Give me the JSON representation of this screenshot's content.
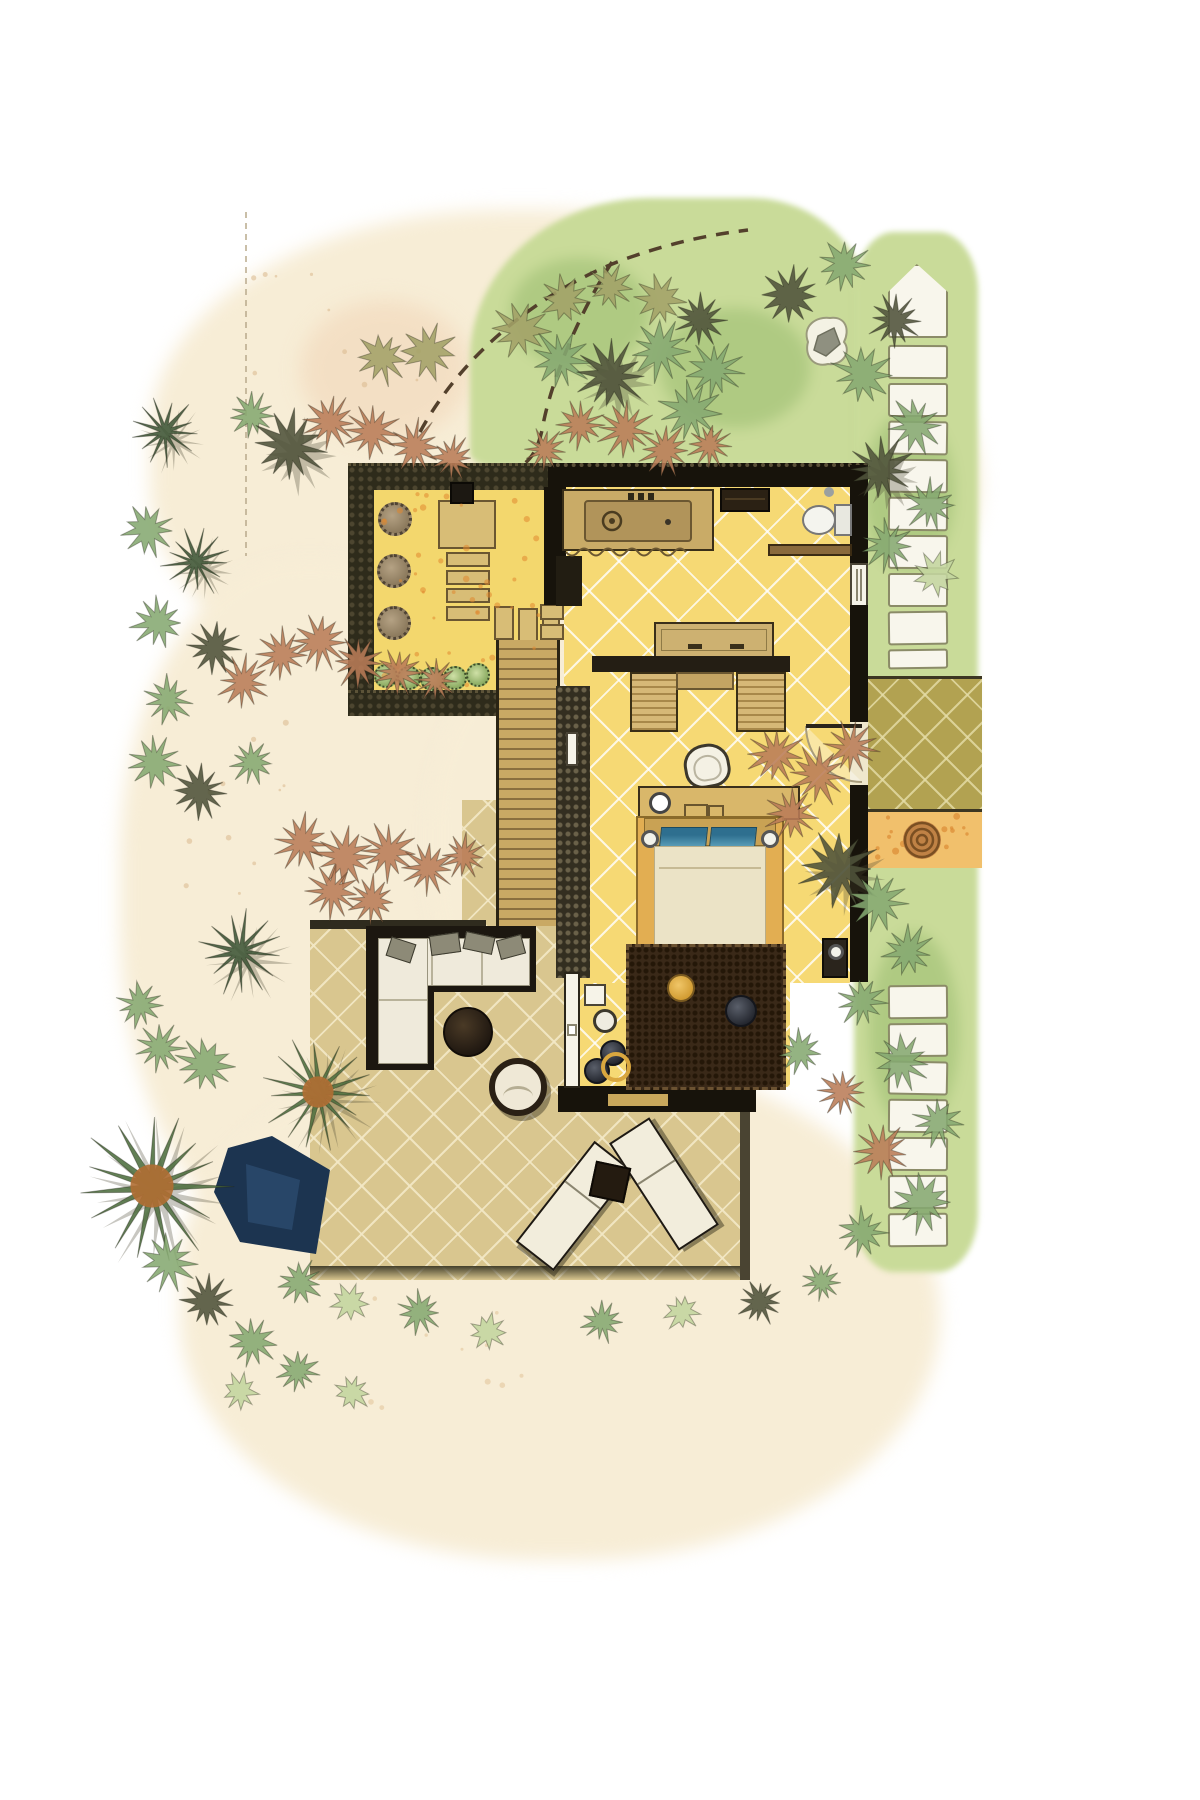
{
  "scene": {
    "kind": "hand-rendered resort villa floor plan, top view, watercolor style",
    "areas": [
      "garden-courtyard",
      "bathroom",
      "bedroom",
      "timber-boardwalk",
      "terrace-deck",
      "entry-porch",
      "plunge-pool",
      "lawn-with-stepping-stones",
      "sand-paths"
    ],
    "palette": {
      "floor_yellow": "#f6d974",
      "deck_tan": "#d9c68f",
      "porch_khaki": "#b2a251",
      "gravel_yellow": "#f3d76d",
      "wall_dark": "#17130b",
      "pool_navy": "#1c3450",
      "lawn_green": "#c9db99",
      "sand_cream": "#f7edd6",
      "pillow_blue": "#2e6f8f",
      "rug_brown": "#3a2918",
      "wood": "#c9a964",
      "shrub_red": "#b97c58"
    }
  },
  "plant_types": {
    "olive": {
      "color": "#a3a268",
      "spikes": 10,
      "inner": 0.45
    },
    "green": {
      "color": "#85a871",
      "spikes": 11,
      "inner": 0.42
    },
    "dark": {
      "color": "#4f523a",
      "spikes": 12,
      "inner": 0.4
    },
    "red": {
      "color": "#b97c58",
      "spikes": 12,
      "inner": 0.38
    },
    "lightgreen": {
      "color": "#c3d59e",
      "spikes": 9,
      "inner": 0.5
    },
    "palm": {
      "color": "#3d5537",
      "spikes": 13,
      "inner": 0.22
    },
    "palm2": {
      "color": "#4c6d3d",
      "spikes": 15,
      "inner": 0.2,
      "center": "#b06e33"
    }
  },
  "plants": [
    [
      382,
      358,
      26,
      "olive"
    ],
    [
      428,
      352,
      28,
      "olive"
    ],
    [
      252,
      415,
      22,
      "green"
    ],
    [
      290,
      447,
      36,
      "dark"
    ],
    [
      330,
      422,
      26,
      "red"
    ],
    [
      372,
      432,
      27,
      "red"
    ],
    [
      415,
      446,
      26,
      "red"
    ],
    [
      452,
      458,
      22,
      "red"
    ],
    [
      520,
      330,
      28,
      "olive"
    ],
    [
      565,
      300,
      24,
      "olive"
    ],
    [
      610,
      287,
      22,
      "olive"
    ],
    [
      660,
      300,
      24,
      "olive"
    ],
    [
      560,
      360,
      30,
      "green"
    ],
    [
      610,
      375,
      36,
      "dark"
    ],
    [
      660,
      350,
      30,
      "green"
    ],
    [
      700,
      320,
      26,
      "dark"
    ],
    [
      715,
      370,
      28,
      "green"
    ],
    [
      690,
      412,
      30,
      "green"
    ],
    [
      625,
      430,
      28,
      "red"
    ],
    [
      580,
      425,
      24,
      "red"
    ],
    [
      545,
      450,
      22,
      "red"
    ],
    [
      665,
      450,
      26,
      "red"
    ],
    [
      710,
      445,
      22,
      "red"
    ],
    [
      790,
      295,
      30,
      "dark"
    ],
    [
      845,
      265,
      26,
      "green"
    ],
    [
      895,
      320,
      26,
      "dark"
    ],
    [
      862,
      375,
      30,
      "green"
    ],
    [
      915,
      425,
      28,
      "green"
    ],
    [
      880,
      470,
      32,
      "dark"
    ],
    [
      930,
      505,
      26,
      "green"
    ],
    [
      888,
      545,
      26,
      "green"
    ],
    [
      935,
      575,
      22,
      "lightgreen"
    ],
    [
      165,
      432,
      32,
      "palm"
    ],
    [
      148,
      530,
      26,
      "green"
    ],
    [
      196,
      562,
      32,
      "palm"
    ],
    [
      158,
      622,
      26,
      "green"
    ],
    [
      214,
      648,
      26,
      "dark"
    ],
    [
      168,
      700,
      24,
      "green"
    ],
    [
      243,
      682,
      26,
      "red"
    ],
    [
      282,
      655,
      26,
      "red"
    ],
    [
      320,
      642,
      28,
      "red"
    ],
    [
      358,
      662,
      26,
      "red"
    ],
    [
      398,
      672,
      24,
      "red"
    ],
    [
      436,
      680,
      22,
      "red"
    ],
    [
      155,
      762,
      26,
      "green"
    ],
    [
      200,
      792,
      28,
      "dark"
    ],
    [
      252,
      762,
      22,
      "green"
    ],
    [
      302,
      842,
      28,
      "red"
    ],
    [
      345,
      856,
      30,
      "red"
    ],
    [
      388,
      852,
      28,
      "red"
    ],
    [
      428,
      868,
      26,
      "red"
    ],
    [
      464,
      856,
      22,
      "red"
    ],
    [
      332,
      892,
      26,
      "red"
    ],
    [
      372,
      900,
      24,
      "red"
    ],
    [
      240,
      952,
      40,
      "palm"
    ],
    [
      205,
      1065,
      28,
      "green"
    ],
    [
      160,
      1048,
      24,
      "green"
    ],
    [
      140,
      1005,
      22,
      "green"
    ],
    [
      318,
      1092,
      52,
      "palm2"
    ],
    [
      152,
      1186,
      72,
      "palm2"
    ],
    [
      300,
      1282,
      22,
      "green"
    ],
    [
      350,
      1302,
      18,
      "lightgreen"
    ],
    [
      168,
      1262,
      28,
      "green"
    ],
    [
      208,
      1302,
      26,
      "dark"
    ],
    [
      252,
      1342,
      24,
      "green"
    ],
    [
      298,
      1372,
      20,
      "green"
    ],
    [
      352,
      1392,
      18,
      "lightgreen"
    ],
    [
      240,
      1392,
      18,
      "lightgreen"
    ],
    [
      775,
      755,
      28,
      "red"
    ],
    [
      818,
      775,
      30,
      "red"
    ],
    [
      852,
      748,
      26,
      "red"
    ],
    [
      792,
      815,
      26,
      "red"
    ],
    [
      838,
      868,
      38,
      "dark"
    ],
    [
      878,
      902,
      30,
      "green"
    ],
    [
      908,
      952,
      26,
      "green"
    ],
    [
      862,
      1002,
      24,
      "green"
    ],
    [
      902,
      1062,
      28,
      "green"
    ],
    [
      938,
      1122,
      24,
      "green"
    ],
    [
      882,
      1152,
      28,
      "red"
    ],
    [
      922,
      1202,
      30,
      "green"
    ],
    [
      862,
      1232,
      24,
      "green"
    ],
    [
      800,
      1052,
      22,
      "green"
    ],
    [
      842,
      1092,
      24,
      "red"
    ],
    [
      420,
      1312,
      22,
      "green"
    ],
    [
      488,
      1332,
      18,
      "lightgreen"
    ],
    [
      602,
      1322,
      20,
      "green"
    ],
    [
      682,
      1312,
      18,
      "lightgreen"
    ],
    [
      760,
      1302,
      22,
      "dark"
    ],
    [
      822,
      1282,
      18,
      "green"
    ]
  ],
  "stepping_stones": {
    "x": 888,
    "w": 60,
    "h": 34,
    "upper_ys": [
      345,
      383,
      421,
      459,
      497,
      535,
      573,
      611
    ],
    "upper_truncated": {
      "y": 649,
      "h": 20
    },
    "lower_ys": [
      985,
      1023,
      1061,
      1099,
      1137,
      1175,
      1213
    ]
  },
  "courtyard": {
    "shrubs": [
      {
        "cx": 395,
        "cy": 519,
        "r": 17
      },
      {
        "cx": 394,
        "cy": 571,
        "r": 17
      },
      {
        "cx": 394,
        "cy": 623,
        "r": 17
      }
    ],
    "steps_col": [
      [
        446,
        552,
        44,
        15
      ],
      [
        446,
        570,
        44,
        15
      ],
      [
        446,
        588,
        44,
        15
      ],
      [
        446,
        606,
        44,
        15
      ]
    ],
    "steps_row": [
      [
        494,
        606,
        20,
        34
      ],
      [
        518,
        608,
        20,
        34
      ],
      [
        542,
        610,
        18,
        34
      ]
    ],
    "steps_down": [
      [
        498,
        648,
        60,
        15
      ],
      [
        498,
        666,
        60,
        15
      ],
      [
        498,
        684,
        60,
        15
      ],
      [
        498,
        702,
        60,
        15
      ],
      [
        498,
        720,
        60,
        15
      ]
    ],
    "west_slabs": [
      [
        540,
        604,
        24,
        16
      ],
      [
        540,
        624,
        24,
        16
      ]
    ],
    "bushes": [
      {
        "cx": 386,
        "cy": 676,
        "r": 12
      },
      {
        "cx": 409,
        "cy": 678,
        "r": 12
      },
      {
        "cx": 432,
        "cy": 679,
        "r": 12
      },
      {
        "cx": 455,
        "cy": 678,
        "r": 12
      },
      {
        "cx": 478,
        "cy": 675,
        "r": 12
      }
    ]
  },
  "bed": {
    "pillows": [
      {
        "x": 660,
        "y": 827,
        "w": 47,
        "h": 22
      },
      {
        "x": 710,
        "y": 827,
        "w": 46,
        "h": 22
      }
    ],
    "bolsters": [
      {
        "x": 656,
        "y": 946,
        "w": 20,
        "h": 16
      },
      {
        "x": 678,
        "y": 946,
        "w": 20,
        "h": 16
      },
      {
        "x": 700,
        "y": 946,
        "w": 20,
        "h": 16
      },
      {
        "x": 722,
        "y": 946,
        "w": 20,
        "h": 16
      },
      {
        "x": 744,
        "y": 946,
        "w": 20,
        "h": 16
      }
    ]
  },
  "bedroom_pots": [
    {
      "kind": "side-table",
      "x": 584,
      "y": 984,
      "w": 22,
      "h": 22
    },
    {
      "kind": "white-ring-pot",
      "cx": 605,
      "cy": 1021,
      "r": 12
    },
    {
      "kind": "dark-pot",
      "cx": 613,
      "cy": 1053,
      "r": 13
    },
    {
      "kind": "dark-pot",
      "cx": 597,
      "cy": 1071,
      "r": 13
    },
    {
      "kind": "yellow-ring",
      "cx": 616,
      "cy": 1067,
      "r": 15
    }
  ],
  "terrace": {
    "sofa_pillows": [
      {
        "x": 388,
        "y": 940,
        "w": 26,
        "h": 20,
        "rot": 18
      },
      {
        "x": 430,
        "y": 934,
        "w": 30,
        "h": 20,
        "rot": -8
      },
      {
        "x": 464,
        "y": 934,
        "w": 30,
        "h": 18,
        "rot": 12
      },
      {
        "x": 498,
        "y": 937,
        "w": 26,
        "h": 20,
        "rot": -15
      }
    ],
    "loungers": [
      {
        "cx": 574,
        "cy": 1206,
        "rot": 38
      },
      {
        "cx": 664,
        "cy": 1184,
        "rot": -33
      }
    ]
  },
  "speckle_zones": [
    {
      "x": 380,
      "y": 492,
      "w": 160,
      "h": 194,
      "n": 42,
      "color": "#e0892f",
      "o": 0.55,
      "r": 2.4
    },
    {
      "x": 870,
      "y": 816,
      "w": 106,
      "h": 46,
      "n": 16,
      "color": "#d9822c",
      "o": 0.6,
      "r": 2.6
    },
    {
      "x": 250,
      "y": 250,
      "w": 200,
      "h": 150,
      "n": 10,
      "color": "#dcbd92",
      "o": 0.6,
      "r": 2.2
    },
    {
      "x": 160,
      "y": 700,
      "w": 180,
      "h": 220,
      "n": 12,
      "color": "#dcbd92",
      "o": 0.6,
      "r": 2.2
    },
    {
      "x": 360,
      "y": 1290,
      "w": 220,
      "h": 130,
      "n": 10,
      "color": "#e2c79c",
      "o": 0.6,
      "r": 2.2
    }
  ]
}
